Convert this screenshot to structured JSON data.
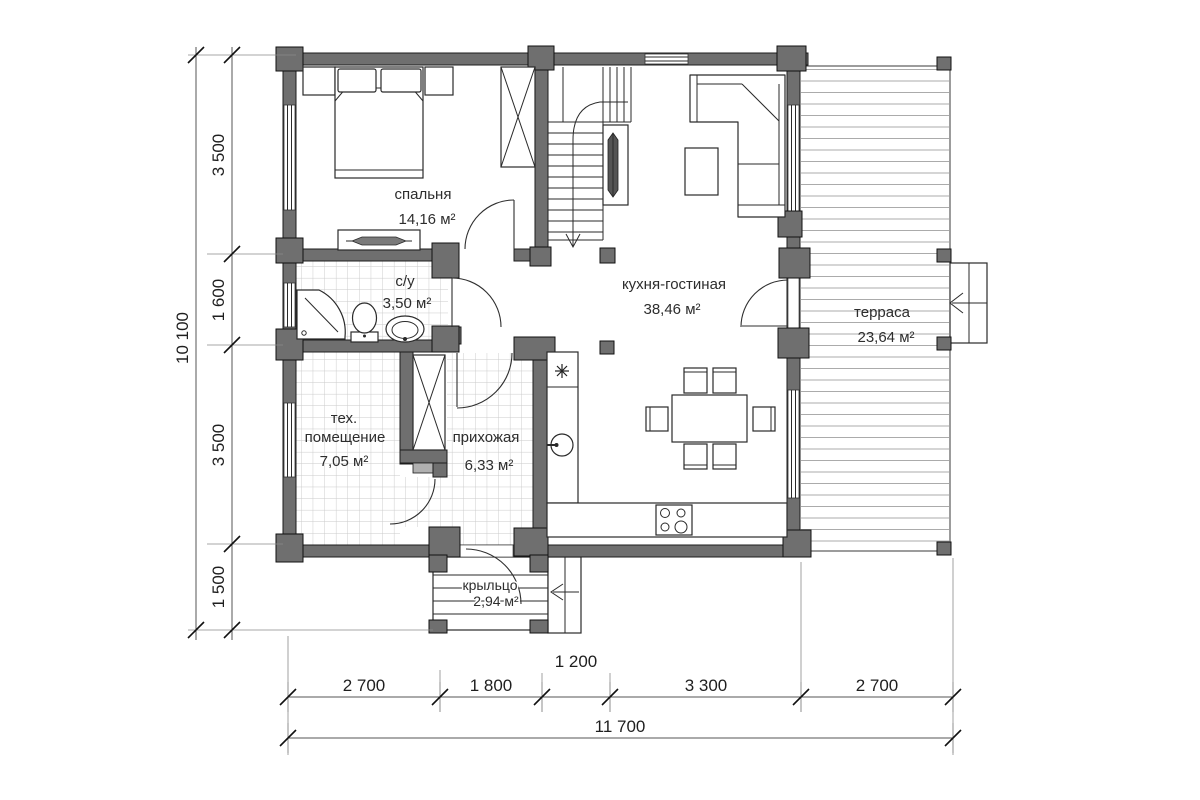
{
  "plan": {
    "rooms": {
      "bedroom": {
        "name": "спальня",
        "area": "14,16 м²"
      },
      "bathroom": {
        "name": "с/у",
        "area": "3,50 м²"
      },
      "kitchen_living": {
        "name": "кухня-гостиная",
        "area": "38,46 м²"
      },
      "terrace": {
        "name": "терраса",
        "area": "23,64 м²"
      },
      "tech_room": {
        "name_line1": "тех.",
        "name_line2": "помещение",
        "area": "7,05 м²"
      },
      "hallway": {
        "name": "прихожая",
        "area": "6,33 м²"
      },
      "porch": {
        "name": "крыльцо",
        "area": "2,94 м²"
      }
    },
    "dimensions": {
      "vertical": {
        "total": "10 100",
        "segments": [
          "3 500",
          "1 600",
          "3 500",
          "1 500"
        ]
      },
      "horizontal": {
        "total": "11 700",
        "segments": [
          "2 700",
          "1 800",
          "1 200",
          "3 300",
          "2 700"
        ]
      }
    },
    "icons": {
      "fridge": "snowflake-icon",
      "sink": "sink-icon",
      "stove": "stove-icon",
      "shower": "shower-icon",
      "toilet": "toilet-icon",
      "washbasin": "washbasin-icon"
    },
    "colors": {
      "wall": "#6f6f6f",
      "wall_outline": "#1c1c1c",
      "tile_line": "#c9c9c9",
      "deck_line": "#ababab",
      "text": "#2d2d2d"
    }
  }
}
